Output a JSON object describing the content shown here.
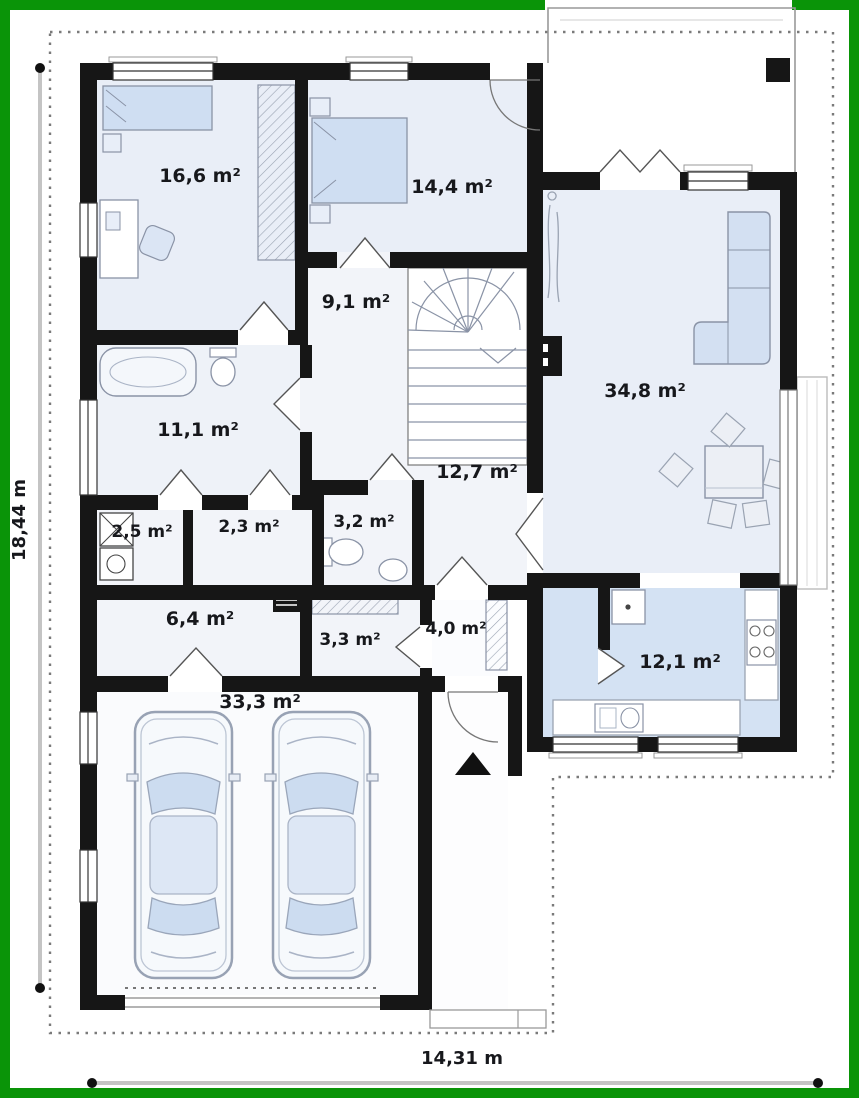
{
  "plan_type": "floor-plan",
  "frame": {
    "border_color": "#0a9408"
  },
  "dimensions": {
    "height_label": "18,44 m",
    "width_label": "14,31 m"
  },
  "rooms": [
    {
      "name": "bedroom-top-left",
      "label": "16,6 m²"
    },
    {
      "name": "bedroom-top-middle",
      "label": "14,4 m²"
    },
    {
      "name": "upper-hall",
      "label": "9,1 m²"
    },
    {
      "name": "living-room",
      "label": "34,8 m²"
    },
    {
      "name": "bathroom",
      "label": "11,1 m²"
    },
    {
      "name": "laundry-closet",
      "label": "2,5 m²"
    },
    {
      "name": "storage-closet",
      "label": "2,3 m²"
    },
    {
      "name": "wc",
      "label": "3,2 m²"
    },
    {
      "name": "main-hall",
      "label": "12,7 m²"
    },
    {
      "name": "utility-room",
      "label": "6,4 m²"
    },
    {
      "name": "rear-corridor",
      "label": "3,3 m²"
    },
    {
      "name": "entry",
      "label": "4,0 m²"
    },
    {
      "name": "garage",
      "label": "33,3 m²"
    },
    {
      "name": "kitchen",
      "label": "12,1 m²"
    }
  ],
  "colors": {
    "wall": "#161616",
    "floor_light": "#e9eef7",
    "floor_hall": "#f2f4f9",
    "floor_blue": "#d4e2f3",
    "furniture_blue": "#cfdef2",
    "dimension_line": "#c4c4c4",
    "thin_line": "#8a93a6",
    "roof_dotted": "#7a7a7a"
  }
}
